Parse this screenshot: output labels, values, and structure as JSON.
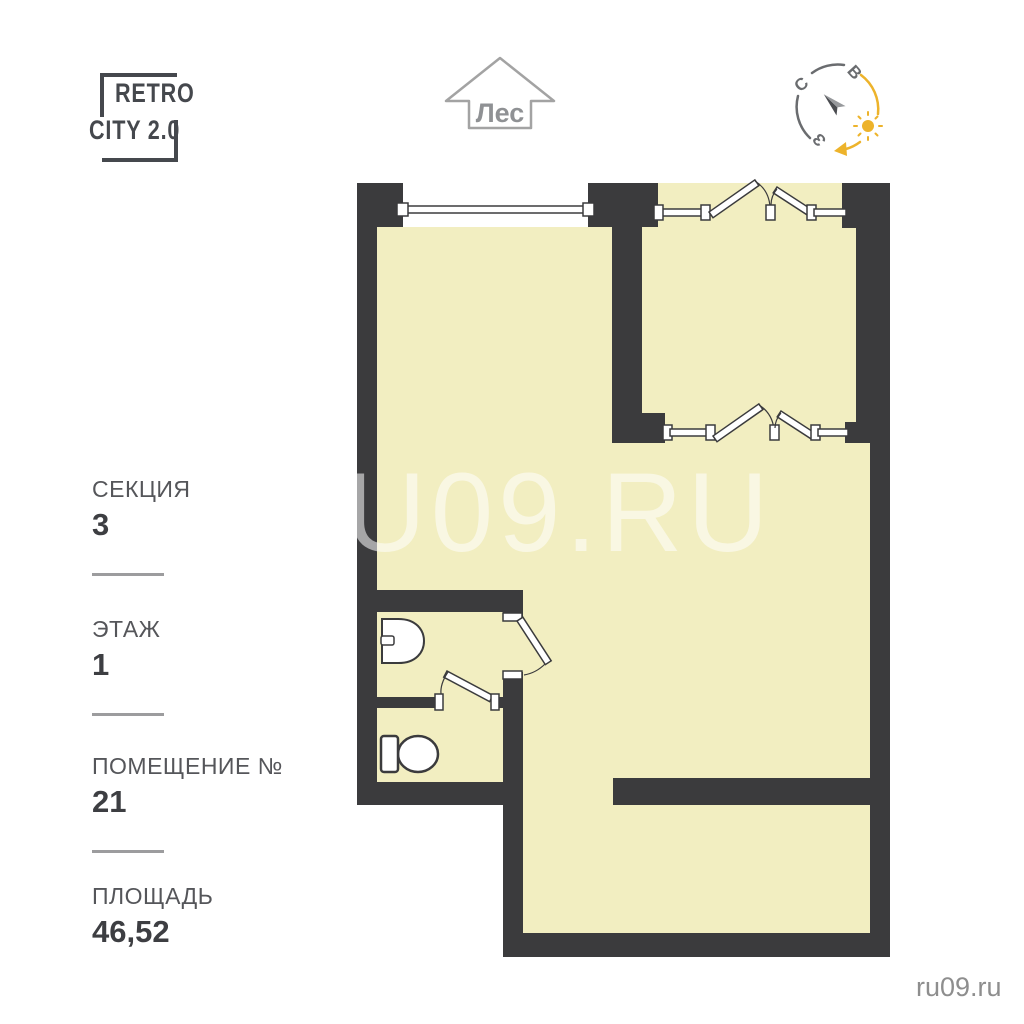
{
  "logo": {
    "line1": "RETRO",
    "line2": "CITY 2.0"
  },
  "orientation": {
    "forest_label": "Лес",
    "compass": {
      "north": "С",
      "east": "В",
      "west": "З"
    }
  },
  "info_panel": {
    "items": [
      {
        "label": "СЕКЦИЯ",
        "value": "3"
      },
      {
        "label": "ЭТАЖ",
        "value": "1"
      },
      {
        "label": "ПОМЕЩЕНИЕ №",
        "value": "21"
      },
      {
        "label": "ПЛОЩАДЬ",
        "value": "46,52"
      }
    ]
  },
  "watermark": "U09.RU",
  "footer": {
    "site": "ru09.ru"
  },
  "colors": {
    "wall": "#3b3b3d",
    "room_fill": "#f2eec1",
    "sun_accent": "#edb32b",
    "label_gray": "#55565a"
  }
}
